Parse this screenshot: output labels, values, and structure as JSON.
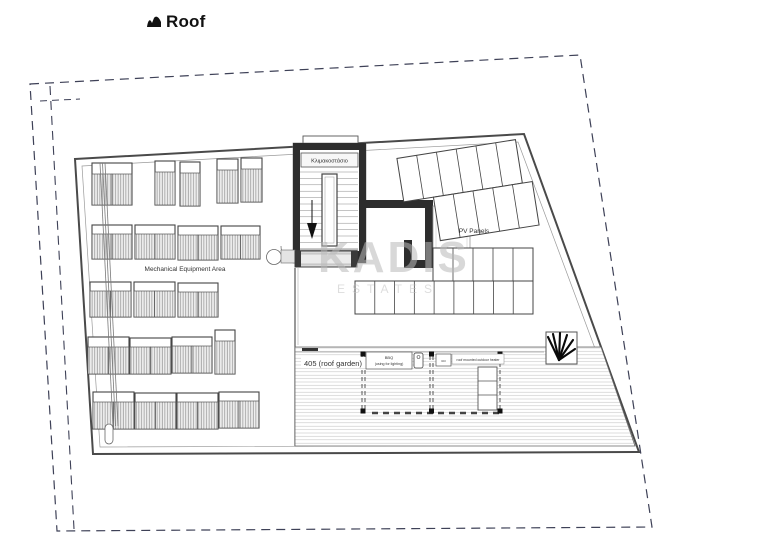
{
  "title": {
    "text": "Roof"
  },
  "watermark": {
    "line1": "KADIS",
    "line2": "ESTATES"
  },
  "plan": {
    "stair_label": "Κλιμακοστάσιο",
    "mech_label": "Mechanical Equipment Area",
    "pv_label": "PV Panels",
    "roof_garden_label": "405 (roof garden)",
    "bbq_label_line1": "BBQ",
    "bbq_label_line2": "(using for lighting)",
    "co_label": "co",
    "heater_label": "roof mounted outdoor heater"
  },
  "colors": {
    "boundary_dash": "#3e4157",
    "wall_dark": "#2d2d2d",
    "plan_line": "#4a4a4a",
    "roof_garden_text": "#a13f3c",
    "watermark_gray": "#bdbdbd"
  }
}
